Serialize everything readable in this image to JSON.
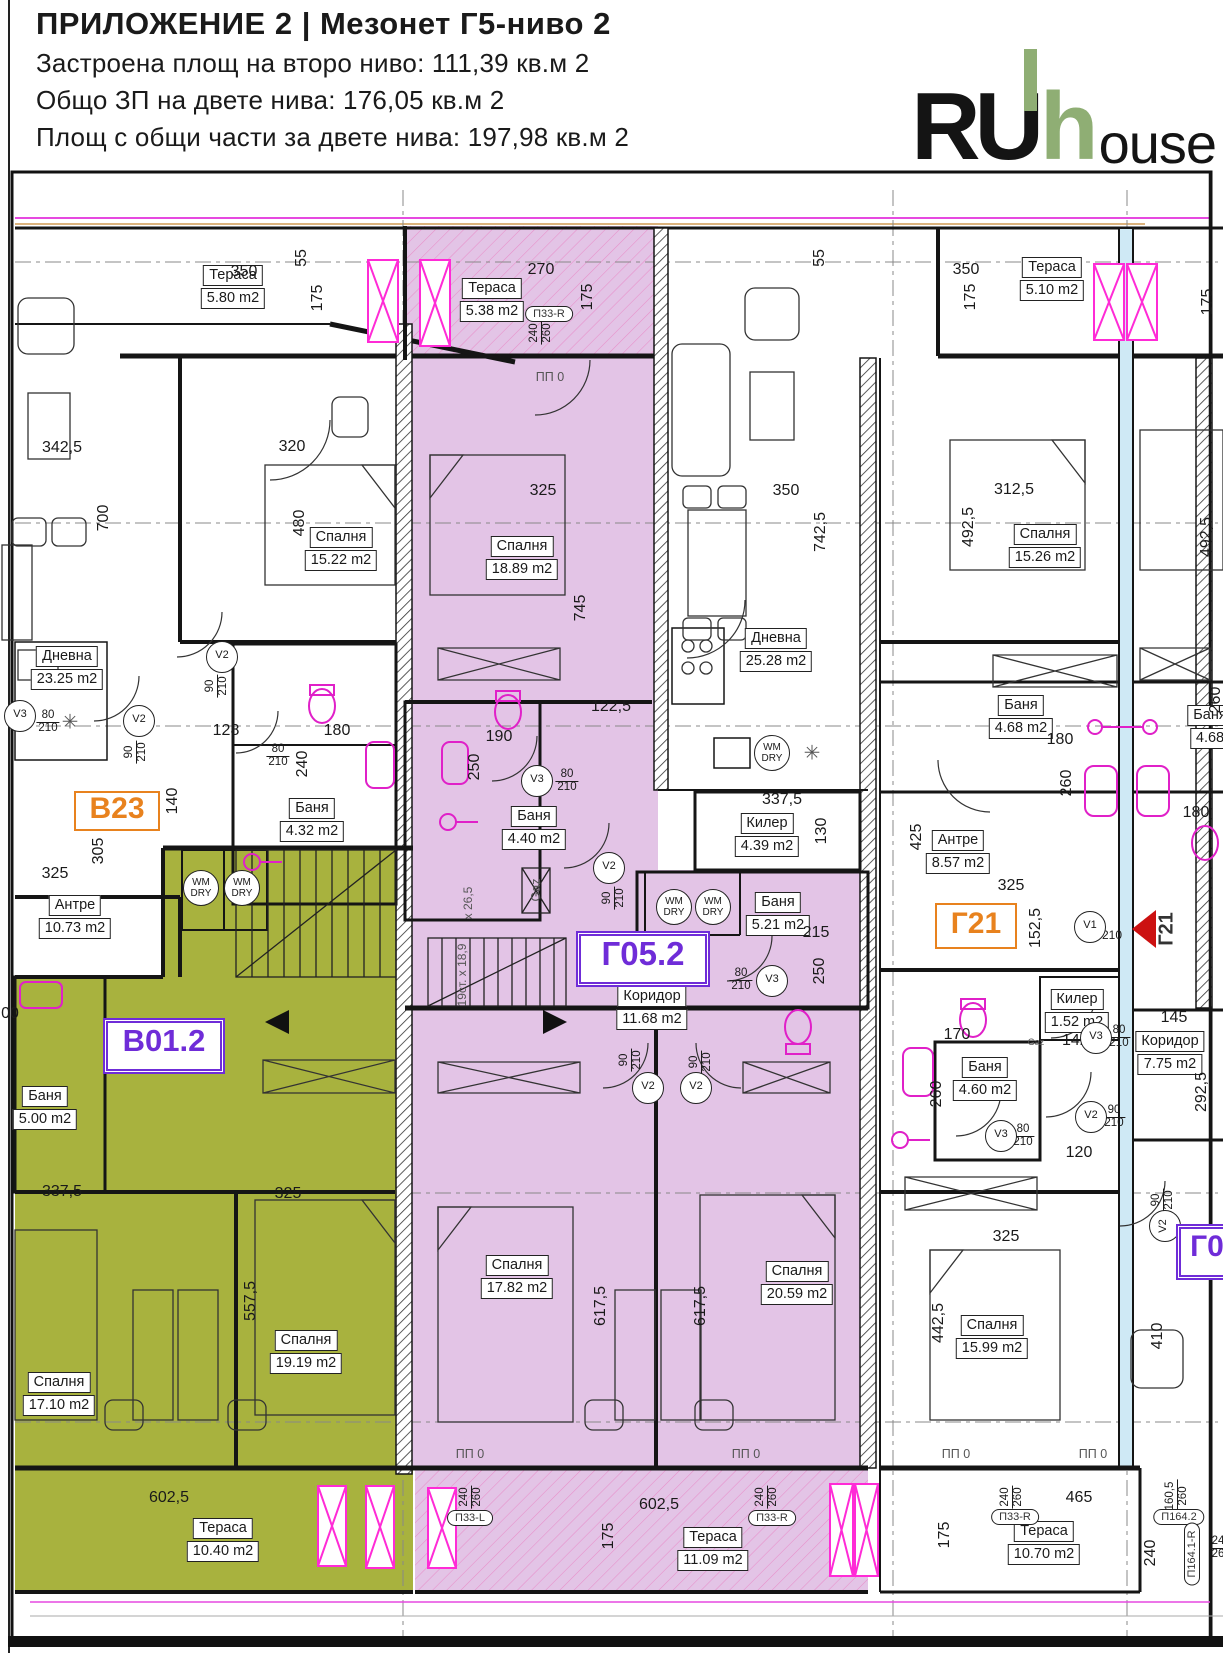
{
  "header": {
    "title": "ПРИЛОЖЕНИЕ 2 | Мезонет Г5-ниво 2",
    "line1": "Застроена площ на второ ниво:  111,39 кв.м 2",
    "line2": "Общо ЗП на двете нива: 176,05 кв.м 2",
    "line3": "Площ с общи части за двете нива: 197,98 кв.м 2"
  },
  "logo": {
    "part1": "RU",
    "part2": "h",
    "part3": "ouse",
    "accent_color": "#8fae74"
  },
  "colors": {
    "apartment_green_fill": "#a8b23e",
    "apartment_purple_fill": "#e3c4e6",
    "tag_orange": "#e8821e",
    "tag_purple": "#6f2cd8",
    "magenta": "#e020c8",
    "red_marker": "#cc1111"
  },
  "plan": {
    "apartment_tags": [
      {
        "id": "В23",
        "x": 117,
        "y": 811,
        "w": 82,
        "h": 36,
        "color": "#e8821e",
        "fs": 30,
        "style": "single"
      },
      {
        "id": "В01.2",
        "x": 164,
        "y": 1046,
        "w": 112,
        "h": 46,
        "color": "#6f2cd8",
        "fs": 31,
        "style": "dbl"
      },
      {
        "id": "Г05.2",
        "x": 643,
        "y": 959,
        "w": 124,
        "h": 46,
        "color": "#6f2cd8",
        "fs": 33,
        "style": "dbl"
      },
      {
        "id": "Г21",
        "x": 976,
        "y": 926,
        "w": 78,
        "h": 42,
        "color": "#e8821e",
        "fs": 30,
        "style": "single"
      },
      {
        "id": "Г0",
        "x": 1207,
        "y": 1252,
        "w": 52,
        "h": 46,
        "color": "#6f2cd8",
        "fs": 30,
        "style": "dbl"
      }
    ],
    "rooms": [
      {
        "name": "Тераса",
        "area": "5.80 m2",
        "x": 233,
        "y": 287
      },
      {
        "name": "Тераса",
        "area": "5.38 m2",
        "x": 492,
        "y": 300
      },
      {
        "name": "Тераса",
        "area": "5.10 m2",
        "x": 1052,
        "y": 279
      },
      {
        "name": "Спалня",
        "area": "15.22 m2",
        "x": 341,
        "y": 549
      },
      {
        "name": "Спалня",
        "area": "18.89 m2",
        "x": 522,
        "y": 558
      },
      {
        "name": "Спалня",
        "area": "15.26 m2",
        "x": 1045,
        "y": 546
      },
      {
        "name": "Дневна",
        "area": "23.25 m2",
        "x": 67,
        "y": 668
      },
      {
        "name": "Дневна",
        "area": "25.28 m2",
        "x": 776,
        "y": 650
      },
      {
        "name": "Баня",
        "area": "4.32 m2",
        "x": 312,
        "y": 820
      },
      {
        "name": "Баня",
        "area": "4.40 m2",
        "x": 534,
        "y": 828
      },
      {
        "name": "Баня",
        "area": "4.68 m2",
        "x": 1021,
        "y": 717
      },
      {
        "name": "Баня",
        "area": "4.68",
        "x": 1210,
        "y": 727
      },
      {
        "name": "Антре",
        "area": "10.73 m2",
        "x": 75,
        "y": 917
      },
      {
        "name": "Антре",
        "area": "8.57 m2",
        "x": 958,
        "y": 852
      },
      {
        "name": "Килер",
        "area": "4.39 m2",
        "x": 767,
        "y": 835
      },
      {
        "name": "Баня",
        "area": "5.21 m2",
        "x": 778,
        "y": 914
      },
      {
        "name": "Коридор",
        "area": "11.68 m2",
        "x": 652,
        "y": 1008
      },
      {
        "name": "Килер",
        "area": "1.52 m2",
        "x": 1077,
        "y": 1011
      },
      {
        "name": "Коридор",
        "area": "7.75 m2",
        "x": 1170,
        "y": 1053
      },
      {
        "name": "Баня",
        "area": "4.60 m2",
        "x": 985,
        "y": 1079
      },
      {
        "name": "Баня",
        "area": "5.00 m2",
        "x": 45,
        "y": 1108
      },
      {
        "name": "Спалня",
        "area": "17.82 m2",
        "x": 517,
        "y": 1277
      },
      {
        "name": "Спалня",
        "area": "20.59 m2",
        "x": 797,
        "y": 1283
      },
      {
        "name": "Спалня",
        "area": "19.19 m2",
        "x": 306,
        "y": 1352
      },
      {
        "name": "Спалня",
        "area": "17.10 m2",
        "x": 59,
        "y": 1394
      },
      {
        "name": "Спалня",
        "area": "15.99 m2",
        "x": 992,
        "y": 1337
      },
      {
        "name": "Тераса",
        "area": "10.40 m2",
        "x": 223,
        "y": 1540
      },
      {
        "name": "Тераса",
        "area": "11.09 m2",
        "x": 713,
        "y": 1549
      },
      {
        "name": "Тераса",
        "area": "10.70 m2",
        "x": 1044,
        "y": 1543
      }
    ],
    "dims": [
      {
        "t": "55",
        "x": 302,
        "y": 258,
        "r": -90
      },
      {
        "t": "350",
        "x": 244,
        "y": 272
      },
      {
        "t": "175",
        "x": 318,
        "y": 298,
        "r": -90
      },
      {
        "t": "270",
        "x": 541,
        "y": 270
      },
      {
        "t": "175",
        "x": 588,
        "y": 297,
        "r": -90
      },
      {
        "t": "55",
        "x": 820,
        "y": 258,
        "r": -90
      },
      {
        "t": "350",
        "x": 966,
        "y": 270
      },
      {
        "t": "175",
        "x": 971,
        "y": 297,
        "r": -90
      },
      {
        "t": "175",
        "x": 1208,
        "y": 302,
        "r": -90
      },
      {
        "t": "342,5",
        "x": 62,
        "y": 448
      },
      {
        "t": "320",
        "x": 292,
        "y": 447
      },
      {
        "t": "700",
        "x": 104,
        "y": 518,
        "r": -90
      },
      {
        "t": "480",
        "x": 300,
        "y": 523,
        "r": -90
      },
      {
        "t": "325",
        "x": 543,
        "y": 491
      },
      {
        "t": "350",
        "x": 786,
        "y": 491
      },
      {
        "t": "742,5",
        "x": 821,
        "y": 532,
        "r": -90
      },
      {
        "t": "312,5",
        "x": 1014,
        "y": 490
      },
      {
        "t": "492,5",
        "x": 969,
        "y": 527,
        "r": -90
      },
      {
        "t": "492,5",
        "x": 1207,
        "y": 537,
        "r": -90
      },
      {
        "t": "745",
        "x": 581,
        "y": 608,
        "r": -90
      },
      {
        "t": "128",
        "x": 226,
        "y": 731
      },
      {
        "t": "180",
        "x": 337,
        "y": 731
      },
      {
        "t": "240",
        "x": 303,
        "y": 764,
        "r": -90
      },
      {
        "t": "140",
        "x": 173,
        "y": 801,
        "r": -90
      },
      {
        "t": "305",
        "x": 99,
        "y": 851,
        "r": -90
      },
      {
        "t": "325",
        "x": 55,
        "y": 874
      },
      {
        "t": "122,5",
        "x": 611,
        "y": 707
      },
      {
        "t": "190",
        "x": 499,
        "y": 737
      },
      {
        "t": "250",
        "x": 475,
        "y": 767,
        "r": -90
      },
      {
        "t": "337,5",
        "x": 782,
        "y": 800
      },
      {
        "t": "130",
        "x": 822,
        "y": 831,
        "r": -90
      },
      {
        "t": "215",
        "x": 816,
        "y": 933
      },
      {
        "t": "250",
        "x": 820,
        "y": 971,
        "r": -90
      },
      {
        "t": "180",
        "x": 1060,
        "y": 740
      },
      {
        "t": "260",
        "x": 1067,
        "y": 783,
        "r": -90
      },
      {
        "t": "425",
        "x": 917,
        "y": 837,
        "r": -90
      },
      {
        "t": "325",
        "x": 1011,
        "y": 886
      },
      {
        "t": "152,5",
        "x": 1036,
        "y": 928,
        "r": -90
      },
      {
        "t": "180",
        "x": 1196,
        "y": 813
      },
      {
        "t": "260",
        "x": 1216,
        "y": 700,
        "r": -90
      },
      {
        "t": "210",
        "x": 1112,
        "y": 935,
        "s": 12
      },
      {
        "t": "170",
        "x": 957,
        "y": 1035
      },
      {
        "t": "142,5",
        "x": 1082,
        "y": 1041
      },
      {
        "t": "145",
        "x": 1174,
        "y": 1018
      },
      {
        "t": "292,5",
        "x": 1202,
        "y": 1092,
        "r": -90
      },
      {
        "t": "260",
        "x": 937,
        "y": 1094,
        "r": -90
      },
      {
        "t": "120",
        "x": 1079,
        "y": 1153
      },
      {
        "t": "325",
        "x": 1006,
        "y": 1237
      },
      {
        "t": "337,5",
        "x": 62,
        "y": 1192
      },
      {
        "t": "325",
        "x": 288,
        "y": 1194
      },
      {
        "t": "557,5",
        "x": 251,
        "y": 1301,
        "r": -90
      },
      {
        "t": "617,5",
        "x": 601,
        "y": 1306,
        "r": -90
      },
      {
        "t": "617,5",
        "x": 701,
        "y": 1306,
        "r": -90
      },
      {
        "t": "602,5",
        "x": 169,
        "y": 1498
      },
      {
        "t": "602,5",
        "x": 659,
        "y": 1505
      },
      {
        "t": "465",
        "x": 1079,
        "y": 1498
      },
      {
        "t": "442,5",
        "x": 939,
        "y": 1323,
        "r": -90
      },
      {
        "t": "410",
        "x": 1158,
        "y": 1336,
        "r": -90
      },
      {
        "t": "240",
        "x": 1151,
        "y": 1553,
        "r": -90
      },
      {
        "t": "175",
        "x": 609,
        "y": 1536,
        "r": -90
      },
      {
        "t": "175",
        "x": 945,
        "y": 1535,
        "r": -90
      },
      {
        "t": "00",
        "x": 10,
        "y": 1014
      }
    ],
    "door_tags": [
      {
        "a": "80",
        "b": "210",
        "x": 48,
        "y": 722
      },
      {
        "a": "90",
        "b": "210",
        "x": 217,
        "y": 686,
        "r": -90
      },
      {
        "a": "90",
        "b": "210",
        "x": 136,
        "y": 752,
        "r": -90
      },
      {
        "a": "80",
        "b": "210",
        "x": 278,
        "y": 756
      },
      {
        "a": "80",
        "b": "210",
        "x": 567,
        "y": 781
      },
      {
        "a": "90",
        "b": "210",
        "x": 614,
        "y": 898,
        "r": -90
      },
      {
        "a": "90",
        "b": "210",
        "x": 631,
        "y": 1060,
        "r": -90
      },
      {
        "a": "90",
        "b": "210",
        "x": 701,
        "y": 1062,
        "r": -90
      },
      {
        "a": "80",
        "b": "210",
        "x": 741,
        "y": 980
      },
      {
        "a": "80",
        "b": "210",
        "x": 1119,
        "y": 1037
      },
      {
        "a": "80",
        "b": "210",
        "x": 1023,
        "y": 1136
      },
      {
        "a": "90",
        "b": "210",
        "x": 1114,
        "y": 1117
      },
      {
        "a": "90",
        "b": "210",
        "x": 1163,
        "y": 1200,
        "r": -90
      }
    ],
    "window_tags": [
      {
        "a": "240",
        "b": "260",
        "x": 541,
        "y": 333,
        "r": -90
      },
      {
        "a": "240",
        "b": "260",
        "x": 471,
        "y": 1497,
        "r": -90
      },
      {
        "a": "240",
        "b": "260",
        "x": 767,
        "y": 1497,
        "r": -90
      },
      {
        "a": "240",
        "b": "260",
        "x": 1012,
        "y": 1497,
        "r": -90
      },
      {
        "a": "160,5",
        "b": "260",
        "x": 1177,
        "y": 1496,
        "r": -90
      },
      {
        "a": "24",
        "b": "26",
        "x": 1218,
        "y": 1548
      }
    ],
    "vent_circles": [
      {
        "t": "V3",
        "x": 20,
        "y": 716
      },
      {
        "t": "V2",
        "x": 222,
        "y": 657
      },
      {
        "t": "V2",
        "x": 139,
        "y": 721
      },
      {
        "t": "V3",
        "x": 537,
        "y": 781
      },
      {
        "t": "V2",
        "x": 609,
        "y": 868
      },
      {
        "t": "V2",
        "x": 648,
        "y": 1088
      },
      {
        "t": "V2",
        "x": 696,
        "y": 1088
      },
      {
        "t": "V3",
        "x": 772,
        "y": 981
      },
      {
        "t": "V3",
        "x": 1096,
        "y": 1038
      },
      {
        "t": "V3",
        "x": 1001,
        "y": 1136
      },
      {
        "t": "V2",
        "x": 1091,
        "y": 1117
      },
      {
        "t": "V2",
        "x": 1165,
        "y": 1226,
        "r": -90
      },
      {
        "t": "V1",
        "x": 1090,
        "y": 927
      }
    ],
    "wm_label": {
      "line1": "WM",
      "line2": "DRY"
    },
    "wm_circles": [
      {
        "x": 201,
        "y": 888
      },
      {
        "x": 242,
        "y": 888
      },
      {
        "x": 674,
        "y": 907
      },
      {
        "x": 713,
        "y": 907
      },
      {
        "x": 772,
        "y": 753
      }
    ],
    "window_ids": [
      {
        "t": "П33-R",
        "x": 549,
        "y": 314
      },
      {
        "t": "П33-L",
        "x": 470,
        "y": 1518
      },
      {
        "t": "П33-R",
        "x": 772,
        "y": 1518
      },
      {
        "t": "П33-R",
        "x": 1015,
        "y": 1517
      },
      {
        "t": "П164.2",
        "x": 1179,
        "y": 1517
      },
      {
        "t": "П164.1-R",
        "x": 1192,
        "y": 1554,
        "r": -90
      }
    ],
    "notes": [
      {
        "t": "ПП 0",
        "x": 550,
        "y": 377
      },
      {
        "t": "ПП 0",
        "x": 470,
        "y": 1454
      },
      {
        "t": "ПП 0",
        "x": 746,
        "y": 1454
      },
      {
        "t": "ПП 0",
        "x": 956,
        "y": 1454
      },
      {
        "t": "ПП 0",
        "x": 1093,
        "y": 1454
      },
      {
        "t": "Gaz",
        "x": 536,
        "y": 890,
        "r": -90
      },
      {
        "t": "Gaz",
        "x": 1036,
        "y": 1042,
        "s": 9
      },
      {
        "t": "19ст. x 18,9",
        "x": 462,
        "y": 975,
        "r": -90,
        "s": 12
      },
      {
        "t": "x 26,5",
        "x": 468,
        "y": 903,
        "r": -90,
        "s": 12
      },
      {
        "t": "✳",
        "x": 70,
        "y": 722,
        "s": 20
      },
      {
        "t": "✳",
        "x": 812,
        "y": 753,
        "s": 20
      },
      {
        "t": "Г21",
        "x": 1167,
        "y": 929,
        "r": -90,
        "s": 20,
        "c": "#333",
        "b": true
      }
    ]
  }
}
